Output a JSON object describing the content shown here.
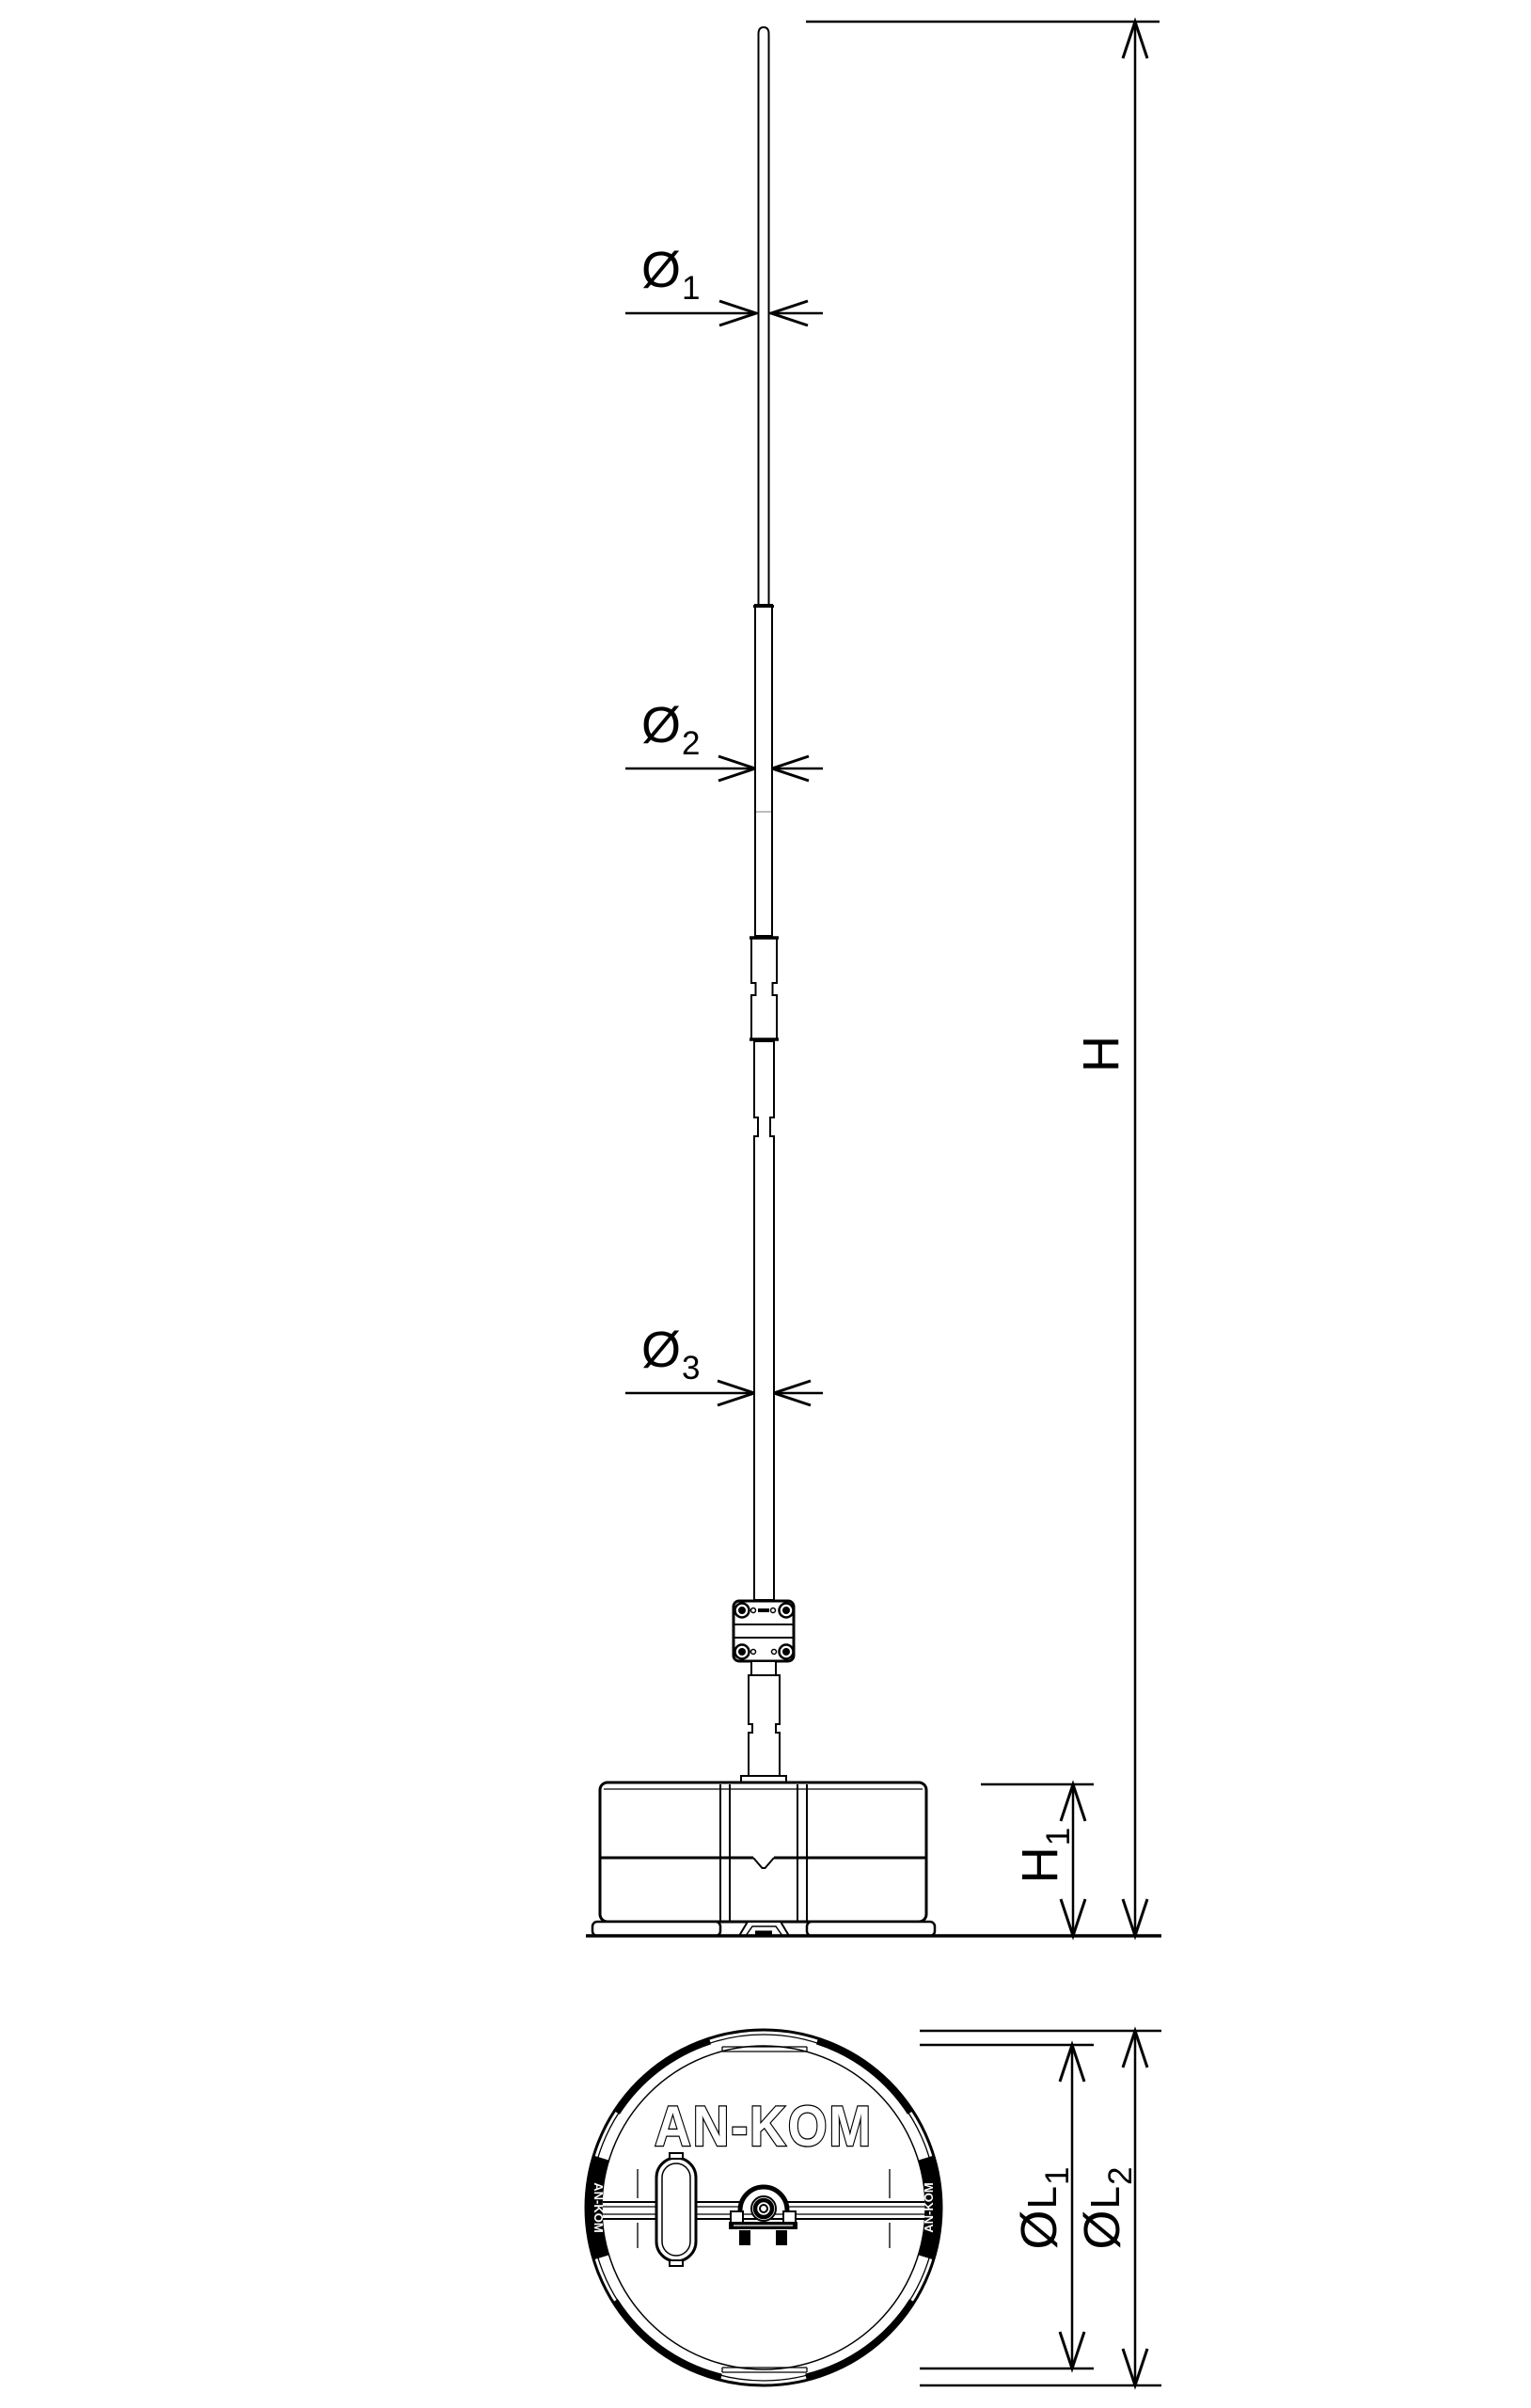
{
  "labels": {
    "dia1": {
      "main": "Ø",
      "mid": "",
      "sub": "1"
    },
    "dia2": {
      "main": "Ø",
      "mid": "",
      "sub": "2"
    },
    "dia3": {
      "main": "Ø",
      "mid": "",
      "sub": "3"
    },
    "height": {
      "main": "H",
      "mid": "",
      "sub": ""
    },
    "height1": {
      "main": "H",
      "mid": "",
      "sub": "1"
    },
    "base_dia1": {
      "main": "Ø",
      "mid": "L",
      "sub": "1"
    },
    "base_dia2": {
      "main": "Ø",
      "mid": "L",
      "sub": "2"
    }
  },
  "brand": {
    "center_logo": "AN-KOM",
    "left_badge": "AN-KOM",
    "right_badge": "AN-KOM"
  },
  "colors": {
    "line": "#000000",
    "background": "#ffffff"
  }
}
